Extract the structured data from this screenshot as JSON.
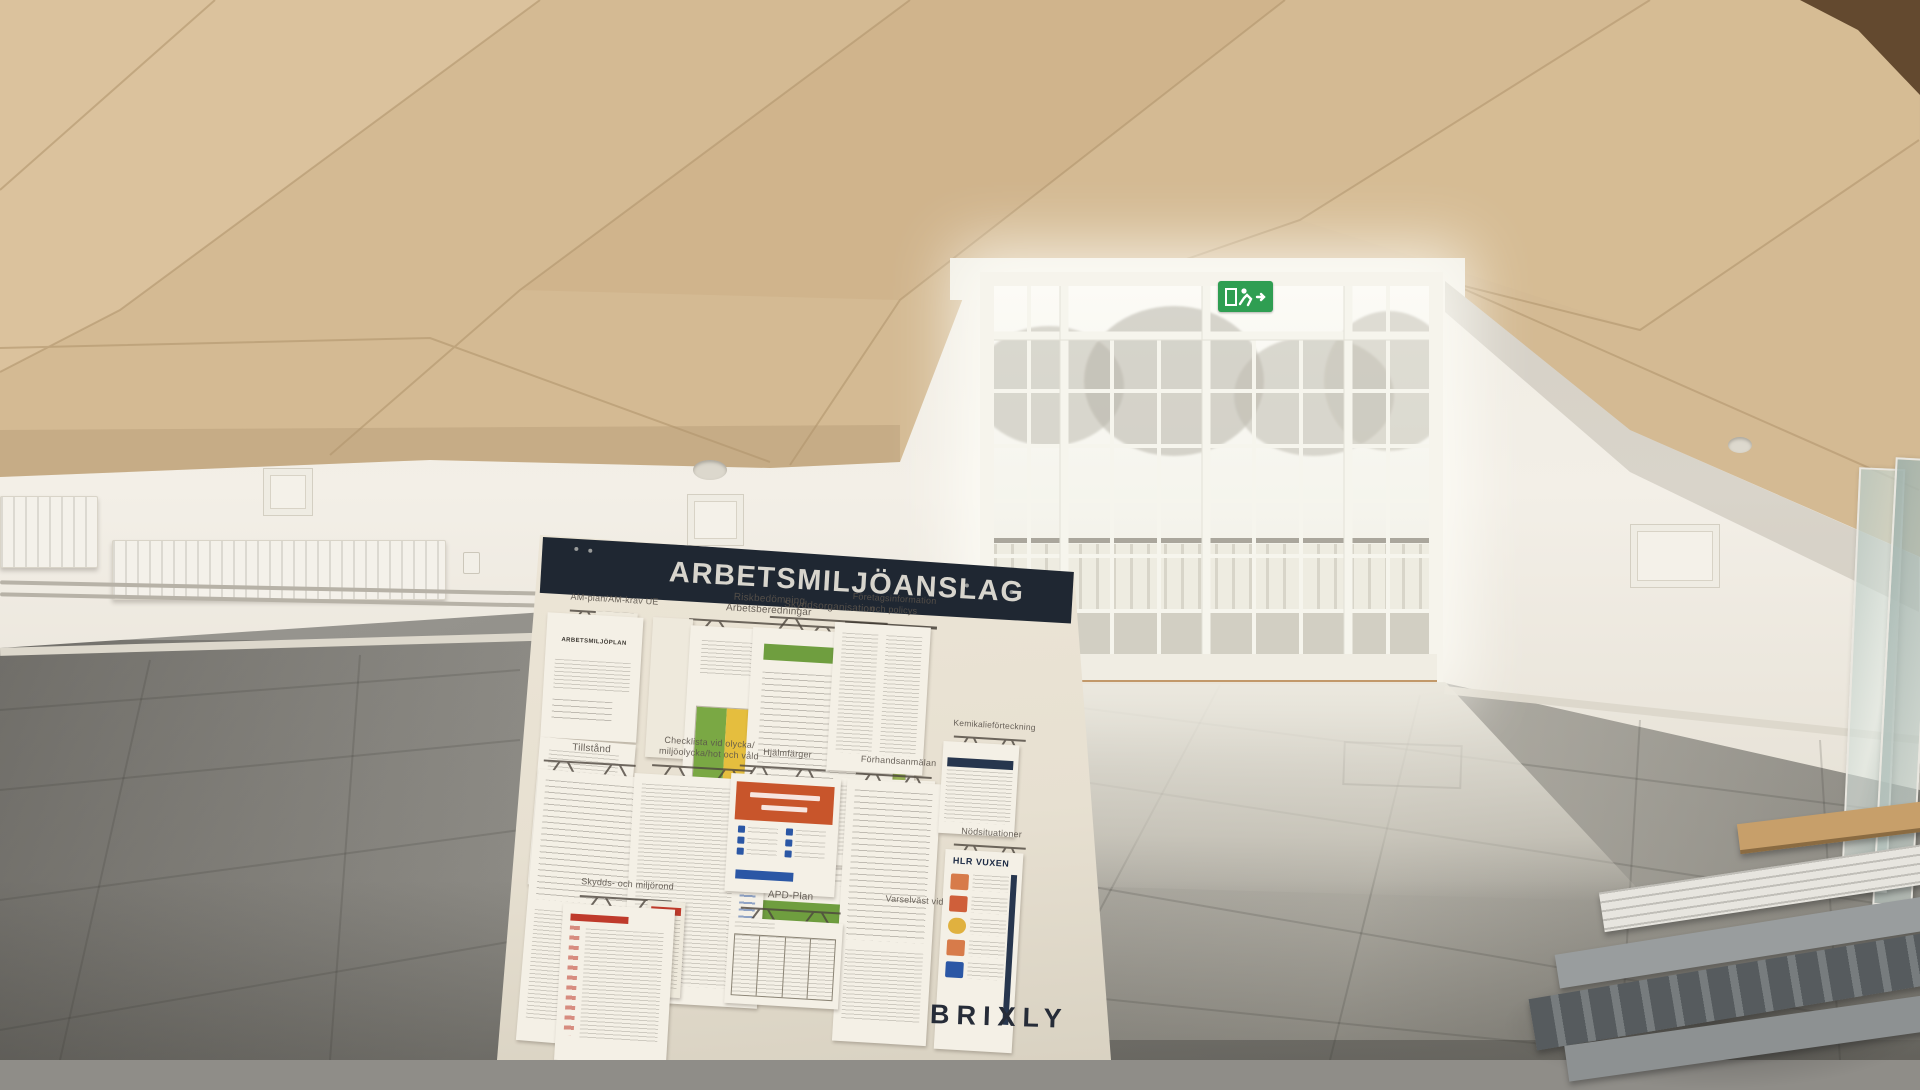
{
  "scene_title": "Arbetsmiljöanslag notice board in empty hall",
  "colors": {
    "banner_navy": "#1f2732",
    "board_surface": "#e8e1d3",
    "ceiling_wood": "#d4ba93",
    "wall_white": "#f1ede4",
    "floor_gray": "#8f8d87",
    "exit_green": "#2f9e52",
    "accent_orange": "#c8552b",
    "accent_green": "#6f9e3f",
    "accent_yellow": "#e5be3e",
    "accent_blue": "#2b57a5",
    "brand_navy": "#262c38"
  },
  "icons": {
    "exit_sign": "running-man-exit",
    "clip": "drawn-paper-clamp"
  },
  "board": {
    "title": "ARBETSMILJÖANSLAG",
    "brand": "BRIXLY",
    "labels": {
      "am_plan": "AM-plan/AM-krav UE",
      "risk_line1": "Riskbedömning",
      "risk_line2": "Arbetsberedningar",
      "skyddsorganisation": "Skyddsorganisation",
      "foretagsinfo_line1": "Företagsinformation",
      "foretagsinfo_line2": "och policys",
      "tillstand": "Tillstånd",
      "checklista_line1": "Checklista vid olycka/",
      "checklista_line2": "miljöolycka/hot och våld",
      "hjalmfarger": "Hjälmfärger",
      "forhandsanmalan": "Förhandsanmälan",
      "kemikalieforteckning": "Kemikalieförteckning",
      "skyddsrond": "Skydds- och miljörond",
      "apd_plan": "APD-Plan",
      "nodsituationer": "Nödsituationer",
      "varselvast": "Varselväst vid"
    },
    "documents": {
      "arbetsmiljoplan": "ARBETSMILJÖPLAN",
      "hlr_vuxen": "HLR VUXEN"
    }
  }
}
